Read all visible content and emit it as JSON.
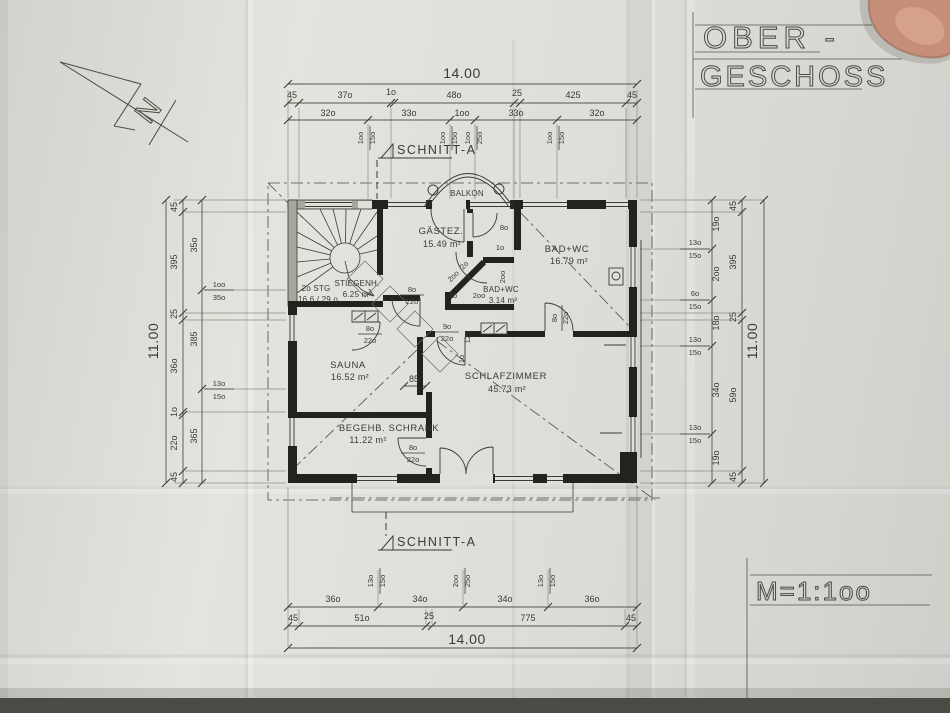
{
  "header": {
    "title_line1": "OBER -",
    "title_line2": "GESCHOSS",
    "scale": "M=1:1oo",
    "north": "N",
    "section": "SCHNITT-A"
  },
  "rooms": {
    "balkon": "BALKON",
    "gaestez": {
      "name": "GÄSTEZ.",
      "area": "15.49 m²"
    },
    "bad_gross": {
      "name": "BAD+WC",
      "area": "16.79 m²"
    },
    "bad_klein": {
      "name": "BAD+WC",
      "area": "3.14 m²"
    },
    "stiegenhaus": {
      "name": "STIEGENH.",
      "area": "6.25 m²"
    },
    "stiege": {
      "l1": "2o STG",
      "l2": "16.6 / 29.o"
    },
    "sauna": {
      "name": "SAUNA",
      "area": "16.52 m²"
    },
    "schrank": {
      "name": "BEGEHB. SCHRANK",
      "area": "11.22 m²"
    },
    "schlafzimmer": {
      "name": "SCHLAFZIMMER",
      "area": "45.73 m²"
    }
  },
  "labels": {
    "d85": "85",
    "d125": "125",
    "door_gz": [
      "8o",
      "22o"
    ],
    "door_sauna": [
      "8o",
      "22o"
    ],
    "door_schlaf": [
      "9o",
      "22o"
    ],
    "door_schrank": [
      "8o",
      "22o"
    ],
    "door_bad": [
      "8o",
      "22o"
    ],
    "gz_corr": "8o",
    "n1": "1o",
    "n2": "2oo",
    "n3": "2o",
    "n4": "2oo",
    "n5": "1o",
    "n6": "2oo",
    "n7": "1o"
  },
  "dims": {
    "top": {
      "overall": "14.00",
      "c1": [
        "45",
        "37o",
        "1o",
        "48o",
        "25",
        "425",
        "45"
      ],
      "c2": [
        "32o",
        "33o",
        "1oo",
        "33o",
        "32o"
      ],
      "p": [
        [
          "1oo",
          "15o"
        ],
        [
          "1oo",
          "15o"
        ],
        [
          "1oo",
          "25o"
        ],
        [
          "1oo",
          "15o"
        ]
      ]
    },
    "bottom": {
      "overall": "14.00",
      "c1": [
        "36o",
        "34o",
        "34o",
        "36o"
      ],
      "c2": [
        "45",
        "51o",
        "25",
        "775",
        "45"
      ],
      "p": [
        [
          "13o",
          "15o"
        ],
        [
          "2oo",
          "25o"
        ],
        [
          "13o",
          "15o"
        ]
      ]
    },
    "left": {
      "overall": "11.00",
      "c1": [
        "45",
        "395",
        "25",
        "36o",
        "1o",
        "22o",
        "45"
      ],
      "c2": [
        "35o",
        "385",
        "365"
      ],
      "p": [
        [
          "1oo",
          "35o"
        ],
        [
          "13o",
          "15o"
        ]
      ]
    },
    "right": {
      "overall": "11.00",
      "c1": [
        "45",
        "395",
        "25",
        "59o",
        "45"
      ],
      "c2": [
        "19o",
        "2oo",
        "18o",
        "34o",
        "19o"
      ],
      "p": [
        [
          "13o",
          "15o"
        ],
        [
          "6o",
          "15o"
        ],
        [
          "13o",
          "15o"
        ],
        [
          "13o",
          "15o"
        ]
      ]
    }
  }
}
